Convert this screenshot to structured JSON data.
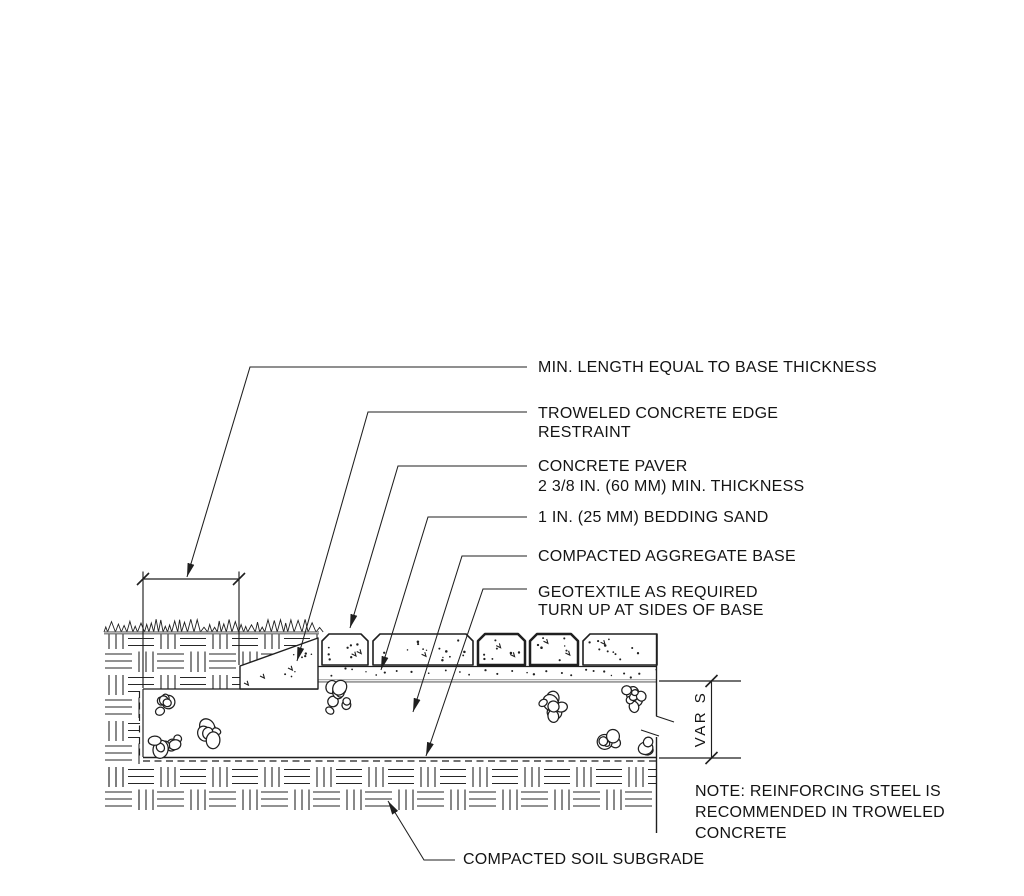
{
  "drawing": {
    "callouts": [
      {
        "id": "min-length",
        "lines": [
          "MIN. LENGTH EQUAL TO BASE THICKNESS"
        ]
      },
      {
        "id": "edge-restraint",
        "lines": [
          "TROWELED CONCRETE EDGE",
          "RESTRAINT"
        ]
      },
      {
        "id": "concrete-paver",
        "lines": [
          "CONCRETE PAVER",
          "2 3/8 IN. (60 MM) MIN. THICKNESS"
        ]
      },
      {
        "id": "bedding-sand",
        "lines": [
          "1 IN. (25 MM) BEDDING SAND"
        ]
      },
      {
        "id": "aggregate-base",
        "lines": [
          "COMPACTED AGGREGATE BASE"
        ]
      },
      {
        "id": "geotextile",
        "lines": [
          "GEOTEXTILE AS REQUIRED",
          "TURN UP AT SIDES OF BASE"
        ]
      }
    ],
    "subgrade_callout": "COMPACTED SOIL SUBGRADE",
    "dimension_varies_label": "VAR S",
    "note_lines": [
      "NOTE: REINFORCING STEEL IS",
      "RECOMMENDED IN TROWELED",
      "CONCRETE"
    ],
    "colors": {
      "line": "#1f1f1f",
      "muted": "#636363",
      "text": "#141414",
      "bg": "#ffffff"
    }
  }
}
